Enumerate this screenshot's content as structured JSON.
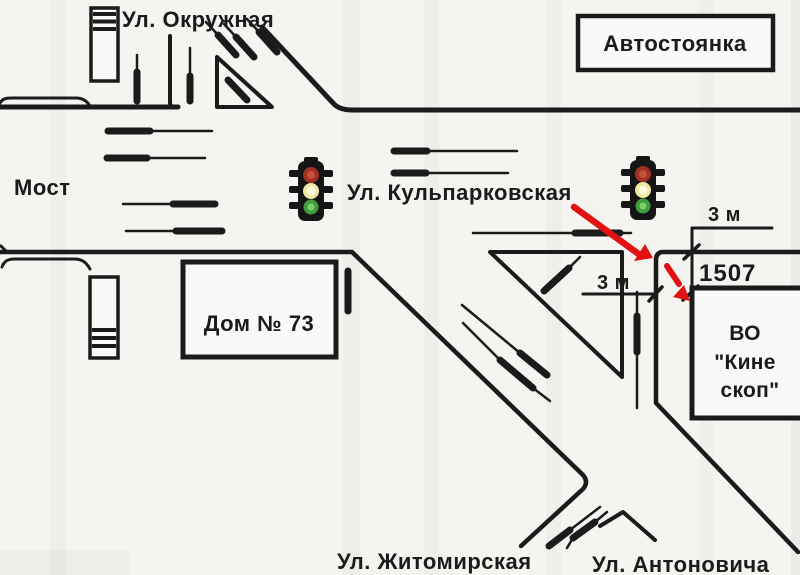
{
  "map": {
    "labels": {
      "okruzhnaya": "Ул. Окружная",
      "parking": "Автостоянка",
      "bridge": "Мост",
      "kulparkovskaya": "Ул. Кульпарковская",
      "house": "Дом № 73",
      "dist_top": "3 м",
      "dist_side": "3 м",
      "gate": "1507",
      "factory_l1": "ВО",
      "factory_l2": "\"Кине",
      "factory_l3": "скоп\"",
      "zhitomirskaya": "Ул. Житомирская",
      "antonovicha": "Ул. Антоновича"
    },
    "colors": {
      "ink": "#1b1b1b",
      "background": "#f5f4f1",
      "paper_white": "#faf9f7",
      "arrow_red": "#e01212",
      "light_red": "#a03024",
      "light_red_core": "#c4523a",
      "light_yellow": "#efe9a2",
      "light_yellow_core": "#fdfbe0",
      "light_green": "#3f9d3f",
      "light_green_core": "#7ed06f"
    },
    "icons": {
      "traffic_light": "traffic-light-icon",
      "building": "building-icon",
      "car_dash": "car-dash-icon",
      "route_arrow": "route-arrow-icon",
      "dimension_tick": "dimension-tick-icon"
    }
  }
}
